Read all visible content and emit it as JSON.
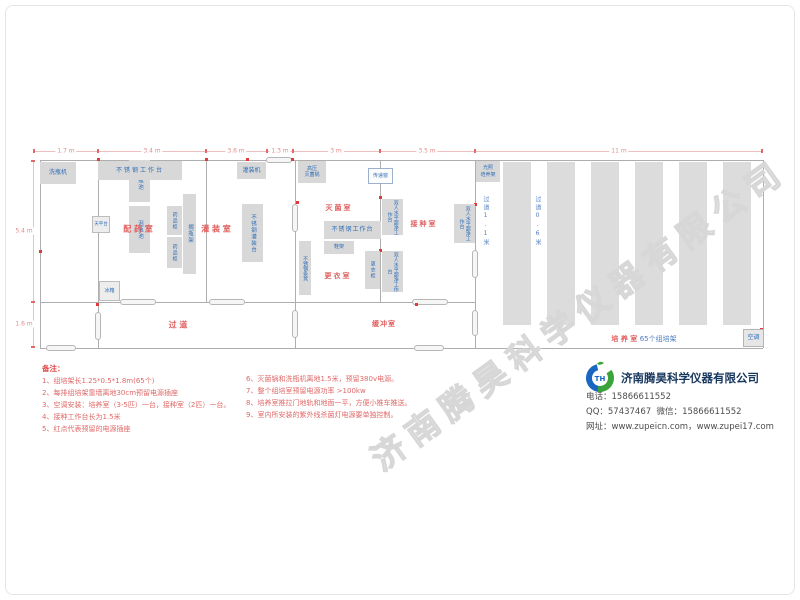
{
  "watermark": "济南腾昊科学仪器有限公司",
  "dimensions": {
    "top": [
      "1.7 m",
      "3.4 m",
      "3.6 m",
      "1.3 m",
      "3 m",
      "3.5 m",
      "11 m"
    ],
    "left": [
      "5.4 m",
      "1.6 m"
    ],
    "aisle_wide": "过道1.1米",
    "aisle_narrow": "过道0.6米"
  },
  "rooms": {
    "peiyao": "配 药 室",
    "guanzhuang": "灌 装 室",
    "miejun": "灭菌室",
    "jiezhong": "接种室",
    "gengyi": "更衣室",
    "guodao": "过    道",
    "huanchong": "缓冲室",
    "peiyang": "培 养 室",
    "peiyang_suffix": "65个组培架"
  },
  "equipment": {
    "xipingji": "洗瓶机",
    "paopingchi": "泡瓶池",
    "worktable": "不锈钢工作台",
    "tianpingtai": "天平台",
    "yaopingui": "药品柜",
    "gepingjia": "搁瓶架",
    "guanzhuangji": "灌装机",
    "guanzhuangtai": "不锈钢灌装台",
    "gaoya_miejunguo": "高压\n灭菌锅",
    "chuandichuang": "传递窗",
    "chaojingtai": "双人水平超净工作台",
    "xiejia": "鞋架",
    "gengyigui": "更衣柜",
    "tiaodeng": "不锈钢条凳",
    "bingxiang": "冰箱",
    "guangzhao": "光照\n培养架",
    "kongtiao": "空调"
  },
  "notes": {
    "title": "备注：",
    "col1": [
      "1、组培架长1.25*0.5*1.8m(65个)",
      "2、每排组培架靠墙离地30cm预留电源插座",
      "3、空调安装：培养室（3-5匹）一台，接种室（2匹）一台。",
      "4、接种工作台长为1.5米",
      "5、红点代表预留的电源插座"
    ],
    "col2": [
      "6、灭菌锅和洗瓶机离地1.5米，预留380v电源。",
      "7、整个组培室预留电源功率 >100kw",
      "8、培养室推拉门地轨和地面一平，方便小推车推送。",
      "9、室内所安装的紫外线杀菌灯电源要单独控制。"
    ]
  },
  "company": {
    "name": "济南腾昊科学仪器有限公司",
    "logo_monogram": "TH",
    "phone_label": "电话：",
    "phone": "15866611552",
    "qq_label": "QQ：",
    "qq": "57437467",
    "wechat_label": "  微信：",
    "wechat": "15866611552",
    "web_label": "网址：",
    "web1": "www.zupeicn.com",
    "web_sep": "，",
    "web2": "www.zupei17.com"
  },
  "colors": {
    "equipment_label_blue": "#2f6db5",
    "room_label_red": "#e05e5e",
    "note_red": "#e06868",
    "dimension_pink": "#e28a8a",
    "wall_gray": "#aeaeae",
    "equipment_fill": "#d8d8d8",
    "company_navy": "#17365d",
    "logo_blue": "#1a67c1",
    "logo_green": "#3aa339",
    "socket_dot_red": "#e03a3a"
  }
}
